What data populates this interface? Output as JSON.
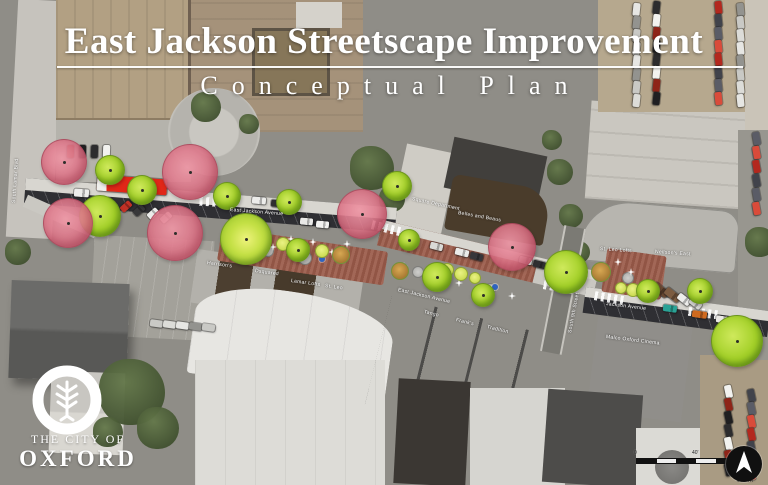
{
  "title": {
    "main": "East Jackson Streetscape Improvement",
    "subtitle": "Conceptual Plan"
  },
  "logo": {
    "line1": "THE CITY OF",
    "line2": "OXFORD"
  },
  "scalebar": {
    "labels": [
      "0",
      "40'",
      "80'"
    ]
  },
  "north": {
    "label": "NORTH"
  },
  "colors": {
    "brick_paving": "#9a5a49",
    "asphalt": "#2f2f33",
    "sidewalk": "#d8d6d0",
    "tree_proposed": "#a3d028",
    "tree_existing": "#e08598",
    "accent_blue": "#2f64c0",
    "fire_truck_red": "#e12718"
  },
  "map_labels": {
    "streets": [
      {
        "t": "East Jackson Avenue",
        "x": 230,
        "y": 207,
        "r": 4.5
      },
      {
        "t": "East Jackson Avenue",
        "x": 398,
        "y": 287,
        "r": 13
      },
      {
        "t": "Jackson Avenue",
        "x": 606,
        "y": 301,
        "r": 7
      },
      {
        "t": "South Lamar Blvd",
        "x": 14,
        "y": 200,
        "r": -86
      },
      {
        "t": "South 9th Street",
        "x": 570,
        "y": 330,
        "r": -79
      }
    ],
    "buildings": [
      {
        "t": "Harrison's",
        "x": 207,
        "y": 260,
        "r": 8
      },
      {
        "t": "Dsquared",
        "x": 255,
        "y": 268,
        "r": 8
      },
      {
        "t": "Lamar Lofts",
        "x": 291,
        "y": 278,
        "r": 8
      },
      {
        "t": "St. Leo",
        "x": 325,
        "y": 283,
        "r": 8
      },
      {
        "t": "Tango",
        "x": 424,
        "y": 309,
        "r": 14
      },
      {
        "t": "Frank's",
        "x": 456,
        "y": 317,
        "r": 14
      },
      {
        "t": "Tradition",
        "x": 487,
        "y": 324,
        "r": 14
      },
      {
        "t": "Square Department",
        "x": 412,
        "y": 196,
        "r": 12
      },
      {
        "t": "Belles and Beaus",
        "x": 458,
        "y": 210,
        "r": 10
      },
      {
        "t": "St. Leo Lofts",
        "x": 600,
        "y": 246,
        "r": 4
      },
      {
        "t": "Neilson's East",
        "x": 655,
        "y": 249,
        "r": 4
      },
      {
        "t": "Malco Oxford Cinema",
        "x": 606,
        "y": 334,
        "r": 7
      }
    ]
  },
  "plan": {
    "trees_existing": [
      [
        64,
        162,
        23
      ],
      [
        68,
        223,
        25
      ],
      [
        190,
        172,
        28
      ],
      [
        175,
        233,
        28
      ],
      [
        362,
        214,
        25
      ],
      [
        512,
        247,
        24
      ]
    ],
    "trees_proposed": [
      [
        110,
        170,
        15
      ],
      [
        100,
        216,
        21
      ],
      [
        142,
        190,
        15
      ],
      [
        227,
        196,
        14
      ],
      [
        289,
        202,
        13
      ],
      [
        246,
        239,
        26,
        "hl"
      ],
      [
        298,
        250,
        12
      ],
      [
        397,
        186,
        15
      ],
      [
        409,
        240,
        11
      ],
      [
        437,
        277,
        15
      ],
      [
        483,
        295,
        12
      ],
      [
        566,
        272,
        22
      ],
      [
        648,
        291,
        12
      ],
      [
        700,
        291,
        13
      ],
      [
        737,
        341,
        26
      ]
    ],
    "trees_small": [
      [
        262,
        240,
        7
      ],
      [
        283,
        244,
        7
      ],
      [
        303,
        248,
        7
      ],
      [
        322,
        251,
        7
      ],
      [
        447,
        270,
        7
      ],
      [
        461,
        274,
        7
      ],
      [
        475,
        278,
        6
      ],
      [
        621,
        288,
        6
      ],
      [
        633,
        290,
        7
      ]
    ],
    "shrubs": [
      [
        245,
        236,
        9
      ],
      [
        341,
        255,
        9
      ],
      [
        400,
        271,
        9
      ],
      [
        601,
        272,
        10
      ]
    ],
    "planters": [
      [
        268,
        251,
        6
      ],
      [
        305,
        258,
        7
      ],
      [
        418,
        272,
        6
      ],
      [
        490,
        289,
        6
      ],
      [
        628,
        278,
        6
      ]
    ],
    "accents_blue": [
      [
        296,
        257
      ],
      [
        322,
        259
      ],
      [
        440,
        281
      ],
      [
        495,
        287
      ]
    ],
    "accents_white": [
      [
        273,
        247
      ],
      [
        291,
        239
      ],
      [
        313,
        242
      ],
      [
        332,
        252
      ],
      [
        347,
        244
      ],
      [
        404,
        266
      ],
      [
        459,
        283
      ],
      [
        512,
        296
      ],
      [
        618,
        262
      ],
      [
        631,
        272
      ]
    ],
    "crosswalks": [
      [
        213,
        202,
        94
      ],
      [
        385,
        228,
        104
      ],
      [
        557,
        287,
        100
      ],
      [
        608,
        298,
        100
      ],
      [
        702,
        313,
        97
      ]
    ],
    "vehicles": [
      [
        97,
        177,
        70,
        16,
        4,
        "firetruck"
      ],
      [
        74,
        189,
        15,
        8,
        4,
        "#ededeb"
      ],
      [
        120,
        203,
        12,
        7,
        -42,
        "#c23126"
      ],
      [
        133,
        207,
        12,
        7,
        -42,
        "#38383a"
      ],
      [
        147,
        210,
        12,
        7,
        -42,
        "#ebebe9"
      ],
      [
        160,
        214,
        12,
        7,
        -42,
        "#dcdcd9"
      ],
      [
        252,
        197,
        14,
        7,
        5,
        "#ececea"
      ],
      [
        271,
        200,
        13,
        7,
        5,
        "#2e2e30"
      ],
      [
        300,
        218,
        13,
        7,
        5,
        "#e9e9e7"
      ],
      [
        316,
        221,
        13,
        7,
        5,
        "#f2f2f0"
      ],
      [
        430,
        243,
        13,
        7,
        14,
        "#d9d9d6"
      ],
      [
        455,
        249,
        14,
        7,
        14,
        "#ebebe9"
      ],
      [
        470,
        253,
        13,
        7,
        14,
        "#36363a"
      ],
      [
        519,
        257,
        13,
        7,
        14,
        "#ededeb"
      ],
      [
        533,
        261,
        13,
        7,
        14,
        "#2f2f31"
      ],
      [
        652,
        286,
        17,
        8,
        38,
        "#6b4a33"
      ],
      [
        664,
        291,
        17,
        8,
        38,
        "#7c5c41"
      ],
      [
        677,
        296,
        14,
        7,
        38,
        "#ededeb"
      ],
      [
        689,
        300,
        13,
        7,
        38,
        "#d8d8d5"
      ],
      [
        663,
        305,
        14,
        7,
        8,
        "#2aa396"
      ],
      [
        692,
        311,
        15,
        7,
        8,
        "#cf6a1f"
      ],
      [
        716,
        316,
        13,
        7,
        8,
        "#ebe9e5"
      ]
    ]
  },
  "background": {
    "trees": [
      [
        372,
        168,
        22
      ],
      [
        392,
        199,
        13
      ],
      [
        560,
        172,
        13
      ],
      [
        571,
        216,
        12
      ],
      [
        579,
        252,
        11
      ],
      [
        132,
        392,
        33
      ],
      [
        158,
        428,
        21
      ],
      [
        108,
        432,
        15
      ],
      [
        206,
        107,
        15
      ],
      [
        249,
        124,
        10
      ],
      [
        18,
        252,
        13
      ],
      [
        760,
        242,
        15
      ],
      [
        552,
        140,
        10
      ]
    ],
    "car_palette": [
      "#e6e6e3",
      "#2c2c2e",
      "#b3281e",
      "#93938f",
      "#f2f2ef",
      "#41434b",
      "#c9c9c5",
      "#8e2418",
      "#5a5c66",
      "#dcdcd8",
      "#1f1f21",
      "#d94b3a"
    ],
    "car_clusters": [
      {
        "x": 630,
        "y": 6,
        "dx": 0,
        "dy": 13,
        "count": 8,
        "rot": 96
      },
      {
        "x": 650,
        "y": 4,
        "dx": 0,
        "dy": 13,
        "count": 8,
        "rot": 96
      },
      {
        "x": 712,
        "y": 4,
        "dx": 0,
        "dy": 13,
        "count": 8,
        "rot": 84
      },
      {
        "x": 734,
        "y": 6,
        "dx": 0,
        "dy": 13,
        "count": 8,
        "rot": 84
      },
      {
        "x": 722,
        "y": 388,
        "dx": 0,
        "dy": 13,
        "count": 7,
        "rot": 78
      },
      {
        "x": 745,
        "y": 392,
        "dx": 0,
        "dy": 13,
        "count": 7,
        "rot": 78
      },
      {
        "x": 150,
        "y": 320,
        "dx": 13,
        "dy": 1,
        "count": 5,
        "rot": 8
      },
      {
        "x": 64,
        "y": 148,
        "dx": 12,
        "dy": 0,
        "count": 4,
        "rot": 92
      },
      {
        "x": 750,
        "y": 135,
        "dx": 0,
        "dy": 14,
        "count": 6,
        "rot": 80
      }
    ]
  }
}
